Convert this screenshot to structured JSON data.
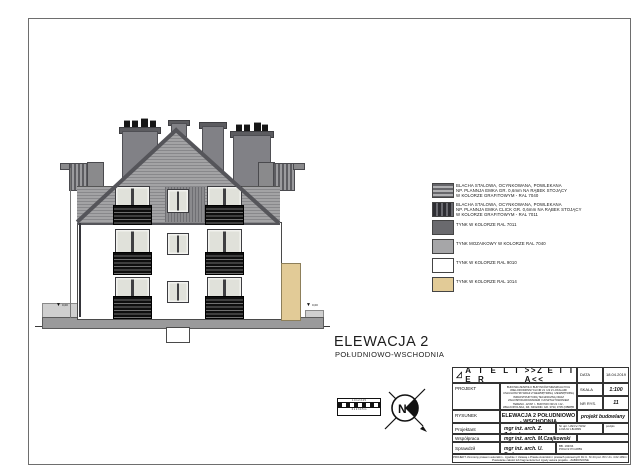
{
  "colors": {
    "ral_7040_blacha": "#9a9a9c",
    "ral_7011_tynk": "#6a6a6e",
    "ral_7040_mozaika": "#a6a6a8",
    "ral_9010_tynk": "#ffffff",
    "ral_1014_tynk": "#e2cb97",
    "railing": "#151515",
    "fascia": "#55555a"
  },
  "drawing": {
    "title": "ELEWACJA 2",
    "subtitle": "POŁUDNIOWO-WSCHODNIA",
    "level_left": "0,00",
    "level_right": "0,00",
    "marker_glyph": "▼",
    "scale_top": "1 0 1 2 3 4 5",
    "scale_bottom": "0 1 2 3 4 5 m",
    "compass_letter": "N"
  },
  "legend": {
    "items": [
      {
        "text": "BLACHA STALOWA, OCYNKOWANA, POWLEKANA\nNP. PLANNJA EMKA GR. 0,6mm NA RĄBEK STOJĄCY\nW KOLORZE GRAFITOWYM - RAL 7040"
      },
      {
        "text": "BLACHA STALOWA, OCYNKOWANA, POWLEKANA\nNP. PLANNJA EMKA CLICK GR. 0,6mm NA RĄBEK STOJĄCY\nW KOLORZE GRAFITOWYM - RAL 7011"
      },
      {
        "text": "TYNK  W KOLORZE RAL 7011"
      },
      {
        "text": "TYNK MOZAIKOWY W KOLORZE RAL 7040"
      },
      {
        "text": "TYNK W KOLORZE RAL 9010"
      },
      {
        "text": "TYNK W KOLORZE RAL 1014"
      }
    ]
  },
  "title_block": {
    "atelier": "A T E L I E R",
    "zetta": ">>Z E T T A<<",
    "data_label": "DATA",
    "data_value": "18.04.2019",
    "projekt_label": "PROJEKT",
    "projekt_description": "BUDOWA ZESPOŁU BUDYNKÓW MIESZKALNYCH WIELORODZINNYCH NR 21 I 22 Z LOKALAMI USŁUGOWYMI WRAZ Z WEWNĘTRZNĄ I ZEWNĘTRZNĄ INFRASTRUKTURĄ TECHNICZNĄ ORAZ ZAGOSPODAROWANIEM I UKSZTAŁTOWANIEM TERENU - ETAP I - BUDYNKI NR 21 I 22 - WIELKOPOLSKA, DZ. NR EWID. GR. 3733, 3735 (OBRĘB 0001)",
    "skala_label": "SKALA",
    "skala_value": "1:100",
    "nr_rys_label": "NR RYS.",
    "nr_rys_value": "11",
    "rysunek_label": "RYSUNEK",
    "rysunek_line1": "ELEWACJA 2 POŁUDNIOWO - WSCHODNIA",
    "rysunek_line2": "ETAP I BUDYNEK NR 21",
    "doc_type": "projekt budowlany",
    "projektant_label": "Projektant",
    "projektant_name": "mgr inż. arch. Z. Zabagło",
    "projektant_stamp": "Nr upr. UAN-V-73/42\nLOIA Nr LB-0839",
    "podpis_label": "podpis",
    "wspolpraca_label": "Współpraca",
    "wspolpraca_name": "mgr inż. arch. M.Czajkowski",
    "sprawdzil_label": "Sprawdził",
    "sprawdzil_name": "mgr inż. arch. U. Bednarz",
    "sprawdzil_stamp": "BB. 193/94\nPOIA Nr PO-0859",
    "copyright": "PROJEKT chroniony prawem autorskim - zgodnie z Ustawą o Prawie Autorskim i prawach pokrewnych Dz.U. Nr 24 poz. 83 z dn. 4.02.1994 r.\nPowielanie całości lub fragmentów bez zgody autora projektu - ZABRONIONE"
  }
}
